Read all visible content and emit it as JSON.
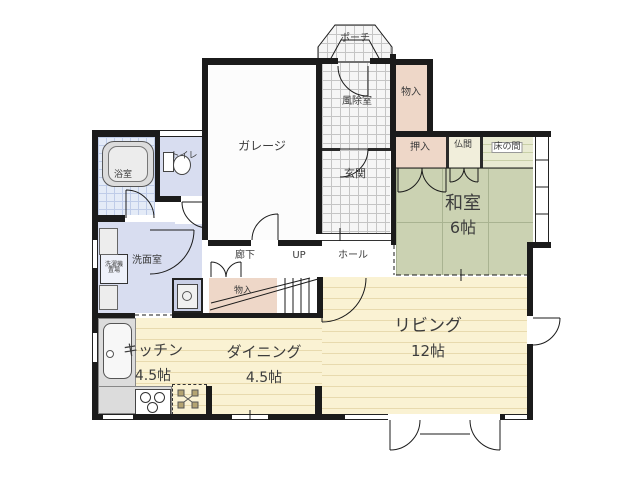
{
  "colors": {
    "wall": "#1b1b1b",
    "tile_bg": "#f6f6f6",
    "tile_line": "#c5c5c5",
    "storage_pink": "#eed7c8",
    "tatami_green": "#cbd2b2",
    "tatami_line": "#a9b391",
    "tokonoma_bg": "#e9ebd2",
    "butsuma_bg": "#f1eedb",
    "floor_cream": "#faf2d3",
    "floor_stripe": "#e8daae",
    "lavender": "#d8ddf0",
    "bath_tile_bg": "#e4ebf7",
    "bath_tile_line": "#bfcce8",
    "fixture_gray": "#dcdcdc",
    "label": "#3c3c3c"
  },
  "rooms": {
    "porch": {
      "label": "ポーチ"
    },
    "windbreak": {
      "label": "風除室"
    },
    "storage_upper": {
      "label": "物入"
    },
    "garage": {
      "label": "ガレージ"
    },
    "entrance": {
      "label": "玄関"
    },
    "closet": {
      "label": "押入"
    },
    "butsuma": {
      "label": "仏間"
    },
    "tokonoma": {
      "label": "床の間"
    },
    "washitsu": {
      "label": "和室",
      "size": "6帖"
    },
    "toilet": {
      "label": "トイレ"
    },
    "bath": {
      "label": "浴室"
    },
    "washroom": {
      "label": "洗面室"
    },
    "laundry": {
      "line1": "洗濯機",
      "line2": "置場"
    },
    "corridor": {
      "label": "廊下"
    },
    "stairs": {
      "label": "UP"
    },
    "hall": {
      "label": "ホール"
    },
    "storage_stairs": {
      "label": "物入"
    },
    "living": {
      "label": "リビング",
      "size": "12帖"
    },
    "dining": {
      "label": "ダイニング",
      "size": "4.5帖"
    },
    "kitchen": {
      "label": "キッチン",
      "size": "4.5帖"
    }
  }
}
